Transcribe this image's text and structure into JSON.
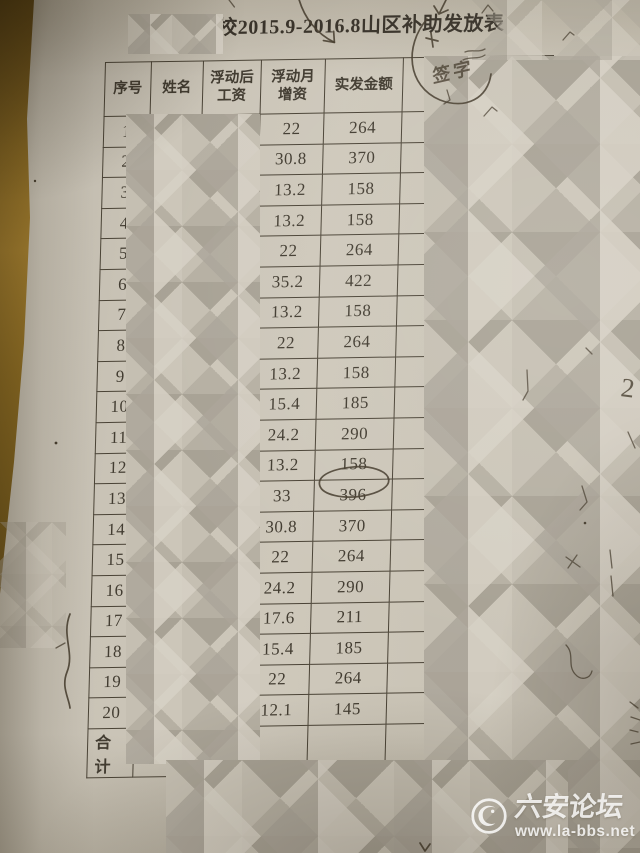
{
  "title": "学校2015.9-2016.8山区补助发放表",
  "table": {
    "headers": {
      "index": "序号",
      "name": "姓名",
      "wage_after_l1": "浮动后",
      "wage_after_l2": "工资",
      "increase_l1": "浮动月",
      "increase_l2": "增资",
      "amount": "实发金额"
    },
    "rows": [
      {
        "no": "1",
        "increase": "22",
        "amount": "264"
      },
      {
        "no": "2",
        "increase": "30.8",
        "amount": "370"
      },
      {
        "no": "3",
        "increase": "13.2",
        "amount": "158"
      },
      {
        "no": "4",
        "increase": "13.2",
        "amount": "158"
      },
      {
        "no": "5",
        "increase": "22",
        "amount": "264"
      },
      {
        "no": "6",
        "increase": "35.2",
        "amount": "422"
      },
      {
        "no": "7",
        "increase": "13.2",
        "amount": "158"
      },
      {
        "no": "8",
        "increase": "22",
        "amount": "264"
      },
      {
        "no": "9",
        "increase": "13.2",
        "amount": "158"
      },
      {
        "no": "10",
        "increase": "15.4",
        "amount": "185"
      },
      {
        "no": "11",
        "increase": "24.2",
        "amount": "290"
      },
      {
        "no": "12",
        "increase": "13.2",
        "amount": "158"
      },
      {
        "no": "13",
        "increase": "33",
        "amount": "396"
      },
      {
        "no": "14",
        "increase": "30.8",
        "amount": "370"
      },
      {
        "no": "15",
        "increase": "22",
        "amount": "264"
      },
      {
        "no": "16",
        "increase": "24.2",
        "amount": "290"
      },
      {
        "no": "17",
        "increase": "17.6",
        "amount": "211"
      },
      {
        "no": "18",
        "increase": "15.4",
        "amount": "185"
      },
      {
        "no": "19",
        "increase": "22",
        "amount": "264"
      },
      {
        "no": "20",
        "increase": "12.1",
        "amount": "145"
      }
    ],
    "footer_label": "合计"
  },
  "annotations": {
    "signature_column_label": "签字",
    "margin_note_right": "2",
    "circled_amount_row": "12"
  },
  "watermark": {
    "site_name": "六安论坛",
    "site_url": "www.la-bbs.net"
  }
}
